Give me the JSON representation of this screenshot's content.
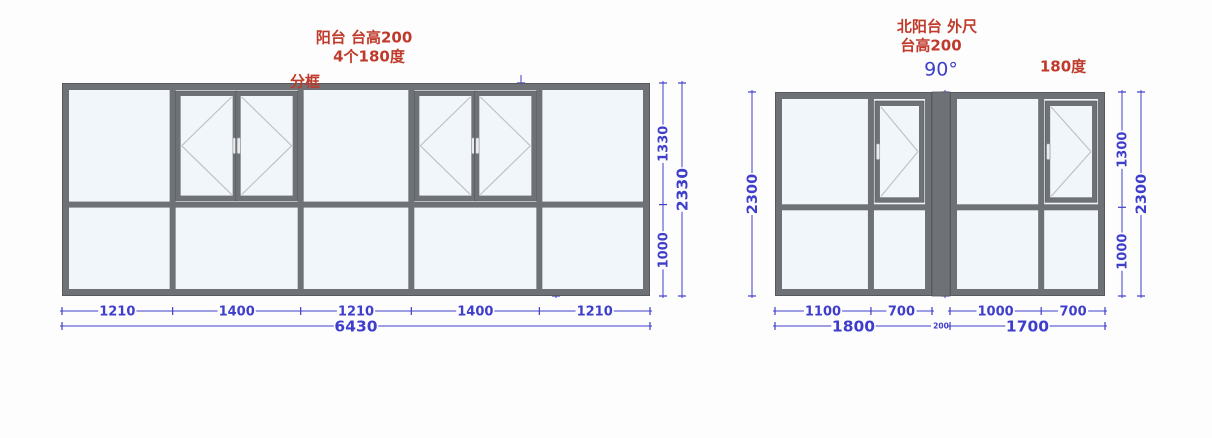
{
  "page": {
    "background": "#fdfdfd"
  },
  "colors": {
    "frame": "#6e7276",
    "frame_dark": "#565a5e",
    "glass": "#f1f6fa",
    "dim": "#3e3ecb",
    "red": "#c03a2b",
    "open_mark": "#bdc3c9",
    "handle": "#e9ebed",
    "page_bg": "#fdfdfd"
  },
  "left_drawing": {
    "title": "阳台  台高200",
    "subtitle": "4个180度",
    "note": "分框",
    "columns_mm": [
      1210,
      1400,
      1210,
      1400,
      1210
    ],
    "column_labels": [
      "1210",
      "1400",
      "1210",
      "1400",
      "1210"
    ],
    "rows_mm": [
      1330,
      1000
    ],
    "row_labels": [
      "1330",
      "1000"
    ],
    "total_width_label": "6430",
    "total_height_label": "2330",
    "casement_columns": [
      1,
      3
    ],
    "casement_sash_labels": [
      "700",
      "700"
    ],
    "interior_top_label": "1330",
    "interior_bottom_label": "1000"
  },
  "right_drawing": {
    "title": "北阳台 外尺",
    "subtitle": "台高200",
    "angle_label": "90°",
    "swing_label": "180度",
    "corner_width_label": "200",
    "rows_mm": [
      1300,
      1000
    ],
    "row_labels": [
      "1300",
      "1000"
    ],
    "post_labels": [
      "1300",
      "1000"
    ],
    "outer_left_label": "2300",
    "outer_right_label": "2300",
    "units": [
      {
        "columns_mm": [
          1100,
          700
        ],
        "column_labels": [
          "1100",
          "700"
        ],
        "total_label": "1800",
        "casement_column": 1,
        "hinge": "right"
      },
      {
        "columns_mm": [
          1000,
          700
        ],
        "column_labels": [
          "1000",
          "700"
        ],
        "total_label": "1700",
        "casement_column": 1,
        "hinge": "right"
      }
    ]
  }
}
